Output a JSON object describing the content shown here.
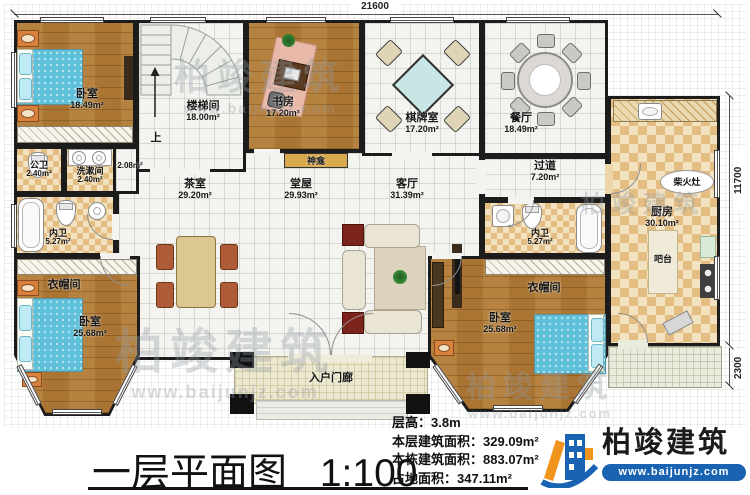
{
  "plan": {
    "dim_top": "21600",
    "dim_right_upper": "11700",
    "dim_right_lower": "2300",
    "rooms": [
      {
        "name": "卧室",
        "area": "18.49m²"
      },
      {
        "name": "楼梯间",
        "area": "18.00m²"
      },
      {
        "name": "书房",
        "area": "17.20m²"
      },
      {
        "name": "棋牌室",
        "area": "17.20m²"
      },
      {
        "name": "餐厅",
        "area": "18.49m²"
      },
      {
        "name": "过道",
        "area": "7.20m²"
      },
      {
        "name": "公卫",
        "area": "2.40m²"
      },
      {
        "name": "洗漱间",
        "area": "2.40m²"
      },
      {
        "name": "内卫",
        "area": "5.27m²"
      },
      {
        "name": "茶室",
        "area": "29.20m²"
      },
      {
        "name": "堂屋",
        "area": "29.93m²"
      },
      {
        "name": "客厅",
        "area": "31.39m²"
      },
      {
        "name": "内卫",
        "area": "5.27m²"
      },
      {
        "name": "衣帽间",
        "area": ""
      },
      {
        "name": "卧室",
        "area": "25.68m²"
      },
      {
        "name": "衣帽间",
        "area": ""
      },
      {
        "name": "卧室",
        "area": "25.68m²"
      },
      {
        "name": "厨房",
        "area": "30.10m²"
      },
      {
        "name": "入户门廊",
        "area": ""
      }
    ],
    "labels": {
      "up": "上",
      "shrine": "神龛",
      "bar": "吧台",
      "wood_stove": "柴火灶",
      "small_area": "2.08m²"
    }
  },
  "footer": {
    "title": "一层平面图",
    "scale": "1:100",
    "stats": [
      {
        "label": "层高：",
        "value": "3.8m"
      },
      {
        "label": "本层建筑面积：",
        "value": "329.09m²"
      },
      {
        "label": "本栋建筑面积：",
        "value": "883.07m²"
      },
      {
        "label": "占地面积：",
        "value": "347.11m²"
      }
    ],
    "logo": {
      "name": "柏竣建筑",
      "site": "www.baijunjz.com"
    }
  },
  "watermark": {
    "text": "柏竣建筑",
    "site": "www.baijunjz.com"
  }
}
